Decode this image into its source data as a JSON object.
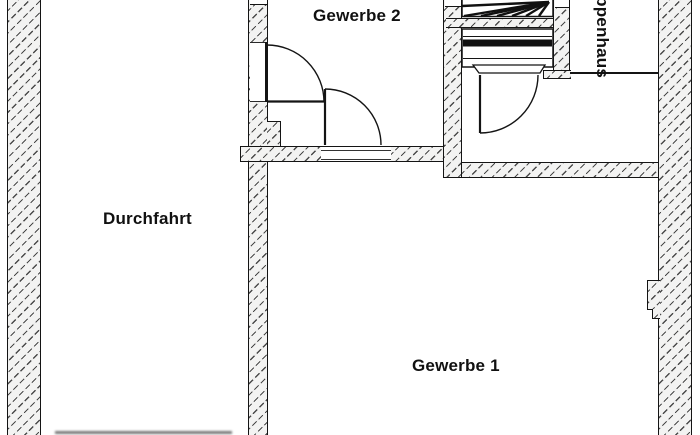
{
  "title": "Floor plan (Grundriss)",
  "labels": {
    "room1": "Gewerbe 1",
    "room2": "Gewerbe 2",
    "passage": "Durchfahrt",
    "stairwell": "Treppenhaus"
  },
  "rooms": [
    {
      "name": "Gewerbe 1",
      "position": "bottom right"
    },
    {
      "name": "Gewerbe 2",
      "position": "top middle"
    },
    {
      "name": "Durchfahrt",
      "position": "left"
    },
    {
      "name": "Treppenhaus",
      "position": "top right, label rotated 90deg, partially cut at top edge"
    }
  ],
  "features": {
    "doors": [
      "door from Durchfahrt into Gewerbe 2 in middle wall",
      "door from Gewerbe 1 into Gewerbe 2 in bottom wall of Gewerbe 2",
      "door at bottom of staircase"
    ],
    "stairs": "winder stairs with fan steps at top, straight flight below, cut off by top image edge"
  },
  "colors": {
    "background": "#ffffff",
    "line": "#141414",
    "wall_fill": "#f3f3f2",
    "hatch_line": "#4a4a4a"
  }
}
